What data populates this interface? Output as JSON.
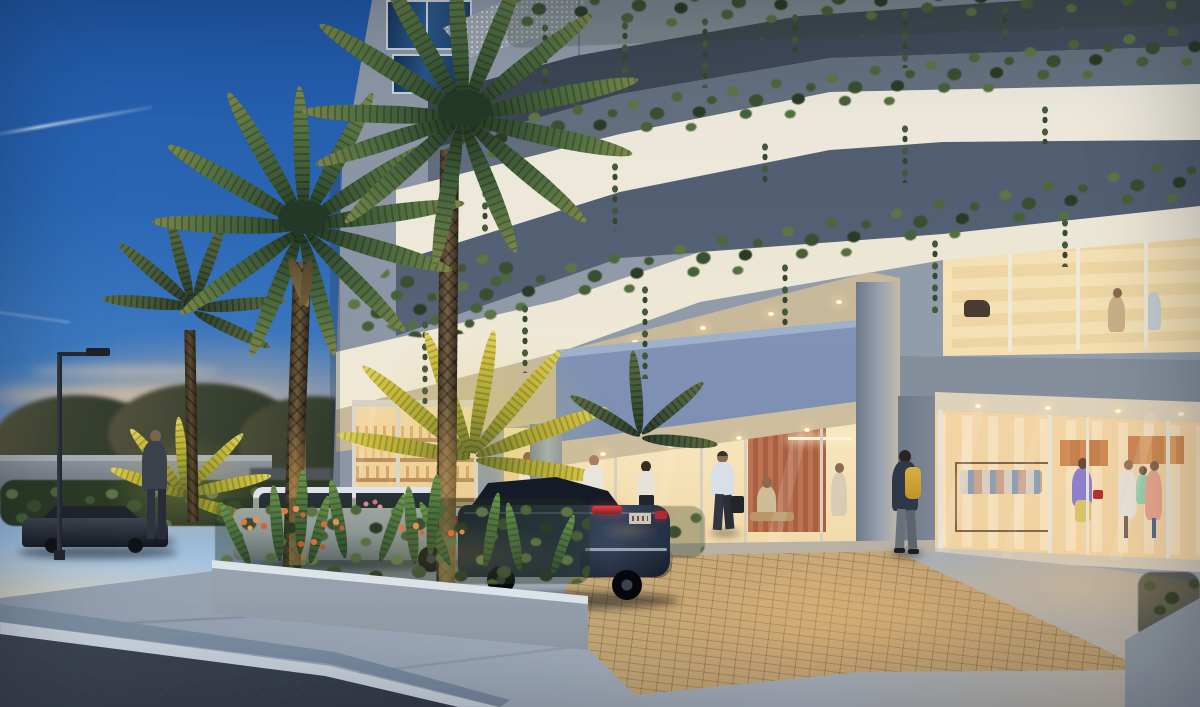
{
  "meta": {
    "title": "Mixed-use tower entrance at dusk",
    "image_type": "photorealistic architectural exterior rendering",
    "time_of_day": "dusk",
    "visible_text": "none (license plate present but illegible)"
  },
  "labels": {
    "scene": "Architectural rendering of a mixed-use building entrance at dusk",
    "sky": "Deep blue dusk sky with jet contrail",
    "backdrop": "Sunset horizon with distant trees and low boundary wall",
    "building": "Modern concrete building with planted balcony edges",
    "tower": "Upper tower floors with glazed windows and perforated metal screen",
    "vines": "Cascading greenery draping from balcony fascias",
    "retail_upper": "Warm-lit second-floor retail gallery",
    "entrance": "Double-height drop-off entrance",
    "canopy": "Blue-grey projecting entrance canopy with downlights",
    "lobby": "Glazed lobby with warm interior and guests",
    "market": "Corner cafe-market storefront with shelving",
    "store_right": "Ground-floor boutique with shoppers and clothing racks",
    "driveway": "Brick-paved drop-off driveway",
    "sidewalk": "Concrete sidewalk apron",
    "street": "Asphalt street with painted edge line and curb",
    "planter": "Concrete planter with ferns and orange flowers",
    "planter_right": "Corner planter with dark shrubs",
    "palms": "Royal palms with lit trunks",
    "golden_palms": "Up-lit golden palm shrubs",
    "suv": "White SUV parked at drop-off",
    "sedan": "Navy luxury sedan at entrance",
    "street_car": "Dark car parked on street",
    "lamp": "Street light pole",
    "people": "Pedestrians, valet staff and shoppers"
  },
  "palette": {
    "sky_top": "#1d53a2",
    "sky_mid": "#3a73bd",
    "sky_horizon_warm": "#f0cfa0",
    "sunset_orange": "#eab584",
    "concrete_light": "#8f99a8",
    "soffit_dark": "#38404f",
    "fascia_white": "#f0ebdd",
    "greenery": "#45543a",
    "interior_warm": "#f6e2b4",
    "canopy_blue": "#8094b4",
    "brick_paver": "#c0a070",
    "sidewalk": "#97a2b2",
    "asphalt": "#3c4350",
    "sedan_navy": "#232e44",
    "suv_white": "#e2e6ea",
    "uplit_palm": "#c9bd45"
  },
  "inventory": {
    "vehicles": [
      "navy sedan at canopy",
      "white SUV behind planter",
      "dark sedan parked on street"
    ],
    "figures": [
      "man in dark suit beside street car",
      "woman walking near shrubs",
      "valet in white shirt at sedan",
      "woman with ponytail at drop-off",
      "man with briefcase entering lobby",
      "man with yellow backpack passing boutique",
      "barista in cafe doorway",
      "guests seated in lobby",
      "shoppers and mannequins in boutique",
      "silhouettes in second-floor gallery"
    ],
    "license_plate_legible": false
  }
}
